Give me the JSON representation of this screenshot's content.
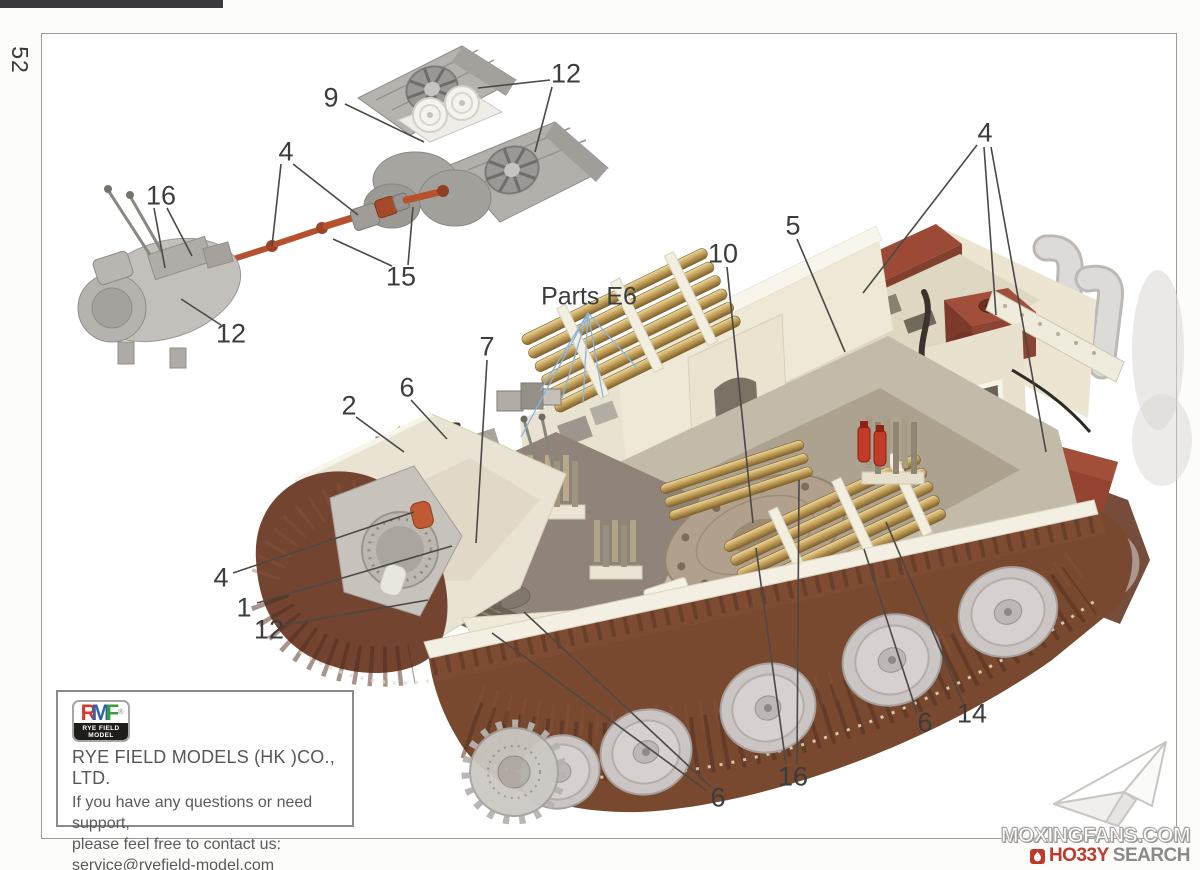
{
  "page": {
    "number": "52"
  },
  "diagram": {
    "parts_label": "Parts E6",
    "callouts": [
      {
        "text": "9"
      },
      {
        "text": "12"
      },
      {
        "text": "4"
      },
      {
        "text": "15"
      },
      {
        "text": "16"
      },
      {
        "text": "12"
      },
      {
        "text": "7"
      },
      {
        "text": "6"
      },
      {
        "text": "2"
      },
      {
        "text": "10"
      },
      {
        "text": "5"
      },
      {
        "text": "4"
      },
      {
        "text": "4"
      },
      {
        "text": "1"
      },
      {
        "text": "12"
      },
      {
        "text": "16"
      },
      {
        "text": "6"
      },
      {
        "text": "6"
      },
      {
        "text": "14"
      }
    ]
  },
  "footer_box": {
    "logo_l1": "R",
    "logo_l2": "M",
    "logo_l3": "F",
    "logo_registered": "®",
    "logo_subtitle": "RYE FIELD MODEL",
    "company": "RYE FIELD MODELS (HK )CO., LTD.",
    "support_line1": "If you have any questions or need support,",
    "support_line2": "please feel free to contact us:",
    "email": "service@ryefield-model.com"
  },
  "watermark": {
    "site": "MOXINGFANS.COM",
    "brand_red": "HO33Y",
    "brand_gray": "SEARCH"
  },
  "colors": {
    "primer_red": "#93432f",
    "hull_cream": "#eee8d6",
    "track_brown": "#78492f",
    "brass": "#c3a05a",
    "callout_line": "#4b4845",
    "parts_line_blue": "#8ab4dd",
    "logo_red": "#d23b2f",
    "logo_blue": "#2f63ae",
    "logo_green": "#35a03a"
  }
}
